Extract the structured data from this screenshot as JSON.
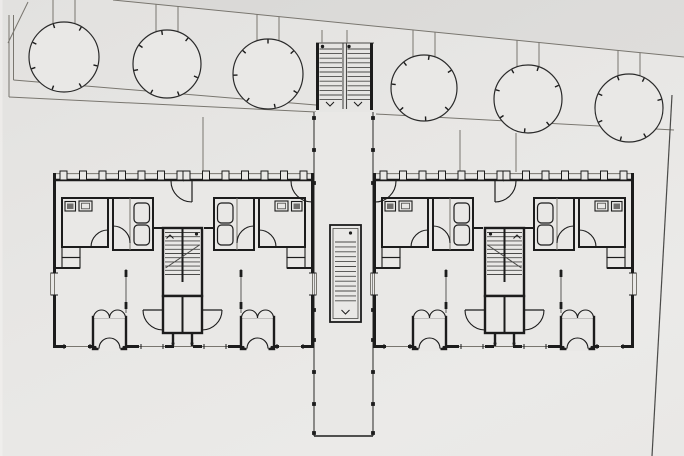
{
  "meta": {
    "title": "Architectural site plan — two mirrored residential buildings linked by a central stair walkway, tree row along the north boundary",
    "drawing_type": "ground-floor site plan, black ink on grey paper"
  },
  "colors": {
    "paper": "#e9e8e6",
    "paperlight": "#f4f3f1",
    "ink": "#1c1c1c",
    "med": "#4a4a48",
    "thin": "#79766f",
    "wc": "#6f6e6c",
    "none": "none"
  },
  "shading": {
    "above_boundary_opacity": 0.045,
    "left_edge_sliver_opacity": 0.55
  },
  "trees": [
    {
      "cx": 64,
      "cy": 57,
      "r": 35
    },
    {
      "cx": 167,
      "cy": 64,
      "r": 34
    },
    {
      "cx": 268,
      "cy": 74,
      "r": 35
    },
    {
      "cx": 424,
      "cy": 88,
      "r": 33
    },
    {
      "cx": 528,
      "cy": 99,
      "r": 34
    },
    {
      "cx": 629,
      "cy": 108,
      "r": 34
    }
  ],
  "tree_style": {
    "tick_angles": [
      15,
      60,
      110,
      160,
      205,
      252,
      300
    ],
    "tick_len": 4.5,
    "stake_offset": 11
  },
  "boundary": {
    "x1": 113,
    "y1": 0,
    "x2": 684,
    "y2": 57
  },
  "site": [
    {
      "t": "line",
      "x1": 113,
      "y1": 0,
      "x2": 684,
      "y2": 57,
      "s": 1,
      "c": "thin"
    },
    {
      "t": "line",
      "x1": 8,
      "y1": 43,
      "x2": 28,
      "y2": 2,
      "s": 1,
      "c": "thin"
    },
    {
      "t": "line",
      "x1": 9,
      "y1": 15,
      "x2": 9,
      "y2": 97,
      "s": 1,
      "c": "thin"
    },
    {
      "t": "line",
      "x1": 13.5,
      "y1": 15,
      "x2": 13.5,
      "y2": 80,
      "s": 1,
      "c": "thin"
    },
    {
      "t": "line",
      "x1": 9,
      "y1": 97,
      "x2": 316,
      "y2": 112,
      "s": 1,
      "c": "thin"
    },
    {
      "t": "line",
      "x1": 13.5,
      "y1": 80,
      "x2": 316,
      "y2": 105,
      "s": 1,
      "c": "thin"
    },
    {
      "t": "line",
      "x1": 376,
      "y1": 114,
      "x2": 674,
      "y2": 130,
      "s": 1,
      "c": "thin"
    },
    {
      "t": "line",
      "x1": 672,
      "y1": 95,
      "x2": 652,
      "y2": 456,
      "s": 1.2,
      "c": "med"
    },
    {
      "t": "line",
      "x1": 203,
      "y1": 117,
      "x2": 203,
      "y2": 172,
      "s": 1,
      "c": "thin"
    },
    {
      "t": "line",
      "x1": 460,
      "y1": 130,
      "x2": 460,
      "y2": 172,
      "s": 1,
      "c": "thin"
    },
    {
      "t": "line",
      "x1": 516,
      "y1": 133,
      "x2": 516,
      "y2": 172,
      "s": 1,
      "c": "thin"
    }
  ],
  "top_stair": [
    {
      "t": "line",
      "x1": 316,
      "y1": 43,
      "x2": 374,
      "y2": 43,
      "s": 1,
      "c": "med"
    },
    {
      "t": "line",
      "x1": 317.5,
      "y1": 43,
      "x2": 317.5,
      "y2": 110,
      "s": 3,
      "c": "ink"
    },
    {
      "t": "line",
      "x1": 371.5,
      "y1": 43,
      "x2": 371.5,
      "y2": 110,
      "s": 3,
      "c": "ink"
    },
    {
      "t": "line",
      "x1": 343,
      "y1": 43,
      "x2": 343,
      "y2": 109,
      "s": 1.1,
      "c": "med"
    },
    {
      "t": "line",
      "x1": 346.5,
      "y1": 43,
      "x2": 346.5,
      "y2": 109,
      "s": 1.1,
      "c": "med"
    },
    {
      "t": "treads",
      "x": 319.5,
      "y": 49,
      "w": 22.5,
      "n": 12,
      "step": 4.6
    },
    {
      "t": "treads",
      "x": 347.5,
      "y": 49,
      "w": 22.5,
      "n": 12,
      "step": 4.6
    },
    {
      "t": "dot",
      "cx": 322.5,
      "cy": 46.5,
      "r": 1.7
    },
    {
      "t": "dot",
      "cx": 349,
      "cy": 46.5,
      "r": 1.7
    },
    {
      "t": "varrow",
      "cx": 330,
      "cy": 106,
      "sz": 4
    },
    {
      "t": "varrow",
      "cx": 358,
      "cy": 106,
      "sz": 4
    },
    {
      "t": "line",
      "x1": 322,
      "y1": 30,
      "x2": 322,
      "y2": 43,
      "s": 1,
      "c": "thin"
    },
    {
      "t": "line",
      "x1": 347,
      "y1": 30,
      "x2": 347,
      "y2": 43,
      "s": 1,
      "c": "thin"
    }
  ],
  "spine": [
    {
      "t": "rect",
      "x": 314.5,
      "y": 112,
      "w": 58,
      "h": 324,
      "s": 0,
      "f": "paper"
    },
    {
      "t": "line",
      "x1": 314,
      "y1": 112,
      "x2": 314,
      "y2": 436,
      "s": 1.2,
      "c": "med"
    },
    {
      "t": "line",
      "x1": 373,
      "y1": 112,
      "x2": 373,
      "y2": 436,
      "s": 1.2,
      "c": "med"
    },
    {
      "t": "line",
      "x1": 314,
      "y1": 436,
      "x2": 373,
      "y2": 436,
      "s": 1.4,
      "c": "ink"
    },
    {
      "t": "posts",
      "xs": [
        314,
        373
      ],
      "ys": [
        118,
        150,
        183,
        310,
        340,
        372,
        404,
        433
      ],
      "sz": 3.8
    },
    {
      "t": "rect",
      "x": 330,
      "y": 225,
      "w": 31,
      "h": 97,
      "s": 1.8,
      "f": "paper"
    },
    {
      "t": "rect",
      "x": 333,
      "y": 228.5,
      "w": 25,
      "h": 90,
      "s": 0.8,
      "f": "none",
      "c": "med"
    },
    {
      "t": "treads",
      "x": 335,
      "y": 242,
      "w": 21,
      "n": 13,
      "step": 4.9
    },
    {
      "t": "dot",
      "cx": 350.5,
      "cy": 233,
      "r": 1.6
    },
    {
      "t": "varrow",
      "cx": 345.5,
      "cy": 314,
      "sz": 4
    }
  ],
  "building_template": {
    "W": 261,
    "H": 175,
    "half": [
      {
        "t": "line",
        "x1": 0,
        "y1": 0.6,
        "x2": 131,
        "y2": 0.6,
        "s": 1,
        "c": "thin"
      },
      {
        "t": "line",
        "x1": 0,
        "y1": 7,
        "x2": 131,
        "y2": 7,
        "s": 2.4,
        "c": "ink"
      },
      {
        "t": "windows",
        "x": 7,
        "y": -2,
        "n": 7,
        "step": 19.5,
        "w": 7,
        "h": 9
      },
      {
        "t": "line",
        "x1": 1.5,
        "y1": 0,
        "x2": 1.5,
        "y2": 100,
        "s": 3,
        "c": "ink"
      },
      {
        "t": "line",
        "x1": 1.5,
        "y1": 122,
        "x2": 1.5,
        "y2": 175,
        "s": 3,
        "c": "ink"
      },
      {
        "t": "line",
        "x1": 1.5,
        "y1": 100,
        "x2": 1.5,
        "y2": 122,
        "s": 1,
        "c": "thin"
      },
      {
        "t": "line",
        "x1": -2.5,
        "y1": 100,
        "x2": 5,
        "y2": 100,
        "s": 1,
        "c": "ink"
      },
      {
        "t": "line",
        "x1": -2.5,
        "y1": 122,
        "x2": 5,
        "y2": 122,
        "s": 1,
        "c": "ink"
      },
      {
        "t": "line",
        "x1": -2.5,
        "y1": 100,
        "x2": -2.5,
        "y2": 122,
        "s": 1,
        "c": "thin"
      },
      {
        "t": "line",
        "x1": 0,
        "y1": 173.5,
        "x2": 13,
        "y2": 173.5,
        "s": 3,
        "c": "ink"
      },
      {
        "t": "line",
        "x1": 13,
        "y1": 173.5,
        "x2": 35,
        "y2": 173.5,
        "s": 1,
        "c": "thin"
      },
      {
        "t": "line",
        "x1": 11,
        "y1": 171,
        "x2": 11,
        "y2": 176,
        "s": 1,
        "c": "ink"
      },
      {
        "t": "line",
        "x1": 37,
        "y1": 171,
        "x2": 37,
        "y2": 176,
        "s": 1,
        "c": "ink"
      },
      {
        "t": "line",
        "x1": 35,
        "y1": 173.5,
        "x2": 42,
        "y2": 173.5,
        "s": 3,
        "c": "ink"
      },
      {
        "t": "line",
        "x1": 71,
        "y1": 173.5,
        "x2": 86,
        "y2": 173.5,
        "s": 3,
        "c": "ink"
      },
      {
        "t": "line",
        "x1": 86,
        "y1": 173.5,
        "x2": 112,
        "y2": 173.5,
        "s": 1,
        "c": "thin"
      },
      {
        "t": "line",
        "x1": 88,
        "y1": 171,
        "x2": 88,
        "y2": 176,
        "s": 1,
        "c": "ink"
      },
      {
        "t": "line",
        "x1": 110,
        "y1": 171,
        "x2": 110,
        "y2": 176,
        "s": 1,
        "c": "ink"
      },
      {
        "t": "line",
        "x1": 112,
        "y1": 173.5,
        "x2": 121,
        "y2": 173.5,
        "s": 3,
        "c": "ink"
      },
      {
        "t": "line",
        "x1": 121,
        "y1": 173.5,
        "x2": 131,
        "y2": 173.5,
        "s": 1,
        "c": "thin"
      },
      {
        "t": "rect",
        "x": 40,
        "y": 144,
        "w": 33,
        "h": 32,
        "s": 2.4,
        "f": "paper"
      },
      {
        "t": "sarc",
        "cx": 48.5,
        "cy": 145,
        "r": 8,
        "s": 1.1
      },
      {
        "t": "sarc",
        "cx": 64.5,
        "cy": 145,
        "r": 8,
        "s": 1.1
      },
      {
        "t": "rect",
        "x": 45.5,
        "y": 172.5,
        "w": 22,
        "h": 5.5,
        "s": 0,
        "f": "paper"
      },
      {
        "t": "qarc",
        "x1": 46,
        "y1": 175.5,
        "x2": 56.5,
        "y2": 165,
        "sw": 1,
        "s": 1.1
      },
      {
        "t": "qarc",
        "x1": 67,
        "y1": 175.5,
        "x2": 56.5,
        "y2": 165,
        "sw": 0,
        "s": 1.1
      },
      {
        "t": "dot",
        "cx": 42,
        "cy": 174.5,
        "r": 1.6
      },
      {
        "t": "dot",
        "cx": 71,
        "cy": 174.5,
        "r": 1.6
      },
      {
        "t": "line",
        "x1": 73,
        "y1": 96,
        "x2": 73,
        "y2": 140,
        "s": 0.9,
        "c": "med"
      },
      {
        "t": "rect",
        "x": 71.6,
        "y": 97,
        "w": 2.8,
        "h": 7,
        "s": 0,
        "f": "ink"
      },
      {
        "t": "rect",
        "x": 71.6,
        "y": 129,
        "w": 2.8,
        "h": 7,
        "s": 0,
        "f": "ink"
      },
      {
        "t": "rect",
        "x": 9,
        "y": 25,
        "w": 46,
        "h": 49,
        "s": 2,
        "f": "none"
      },
      {
        "t": "rect",
        "x": 12,
        "y": 28.5,
        "w": 10.5,
        "h": 9.5,
        "s": 1.1,
        "f": "paper"
      },
      {
        "t": "rect",
        "x": 14,
        "y": 30.5,
        "w": 6.5,
        "h": 5.5,
        "s": 0,
        "f": "wc"
      },
      {
        "t": "rect",
        "x": 26,
        "y": 28,
        "w": 13,
        "h": 10,
        "s": 1.1,
        "f": "paper"
      },
      {
        "t": "rect",
        "x": 28.5,
        "y": 30.2,
        "w": 8,
        "h": 5.6,
        "s": 0.8,
        "f": "none",
        "c": "med"
      },
      {
        "t": "qarc",
        "x1": 38,
        "y1": 74,
        "x2": 55,
        "y2": 57,
        "sw": 1,
        "s": 1.1
      },
      {
        "t": "rect",
        "x": 9,
        "y": 74,
        "w": 18,
        "h": 10.5,
        "s": 1.1,
        "f": "none"
      },
      {
        "t": "rect",
        "x": 9,
        "y": 84.5,
        "w": 18,
        "h": 10.5,
        "s": 1.1,
        "f": "none"
      },
      {
        "t": "line",
        "x1": 0,
        "y1": 95,
        "x2": 27,
        "y2": 95,
        "s": 2,
        "c": "ink"
      },
      {
        "t": "rect",
        "x": 60,
        "y": 25,
        "w": 40,
        "h": 52,
        "s": 2,
        "f": "none"
      },
      {
        "t": "rect",
        "x": 81,
        "y": 30,
        "w": 15.5,
        "h": 20,
        "rx": 4,
        "s": 1.2,
        "f": "paper"
      },
      {
        "t": "rect",
        "x": 81,
        "y": 52,
        "w": 15.5,
        "h": 20,
        "rx": 4,
        "s": 1.2,
        "f": "paper"
      },
      {
        "t": "line",
        "x1": 77,
        "y1": 25,
        "x2": 77,
        "y2": 77,
        "s": 1,
        "c": "thin"
      },
      {
        "t": "qarc",
        "x1": 60,
        "y1": 53,
        "x2": 77,
        "y2": 70,
        "sw": 1,
        "s": 1.1
      },
      {
        "t": "line",
        "x1": 55,
        "y1": 25,
        "x2": 60,
        "y2": 25,
        "s": 2,
        "c": "ink"
      },
      {
        "t": "line",
        "x1": 100,
        "y1": 55,
        "x2": 110,
        "y2": 55,
        "s": 2,
        "c": "ink"
      }
    ],
    "once": [
      {
        "t": "rect",
        "x": 110,
        "y": 55,
        "w": 39,
        "h": 68,
        "s": 2.4,
        "f": "paper"
      },
      {
        "t": "treads",
        "x": 112,
        "y": 59.5,
        "w": 35,
        "n": 11,
        "step": 4.2
      },
      {
        "t": "line",
        "x1": 129.5,
        "y1": 55,
        "x2": 129.5,
        "y2": 109,
        "s": 2,
        "c": "ink"
      },
      {
        "t": "line",
        "x1": 112.5,
        "y1": 95,
        "x2": 146.5,
        "y2": 72,
        "s": 1,
        "c": "med"
      },
      {
        "t": "aarrow",
        "cx": 117,
        "cy": 62,
        "sz": 3.5
      },
      {
        "t": "dot",
        "cx": 143.5,
        "cy": 61,
        "r": 1.6
      },
      {
        "t": "rect",
        "x": 110,
        "y": 123,
        "w": 39,
        "h": 37,
        "s": 2.4,
        "f": "paper"
      },
      {
        "t": "line",
        "x1": 129.5,
        "y1": 123,
        "x2": 129.5,
        "y2": 160,
        "s": 2,
        "c": "ink"
      },
      {
        "t": "qarc",
        "x1": 90,
        "y1": 137,
        "x2": 110,
        "y2": 157,
        "sw": 0,
        "s": 1.1
      },
      {
        "t": "line",
        "x1": 90,
        "y1": 137,
        "x2": 110,
        "y2": 137,
        "s": 1.2,
        "c": "ink"
      },
      {
        "t": "qarc",
        "x1": 169,
        "y1": 137,
        "x2": 149,
        "y2": 157,
        "sw": 1,
        "s": 1.1
      },
      {
        "t": "line",
        "x1": 149,
        "y1": 137,
        "x2": 169,
        "y2": 137,
        "s": 1.2,
        "c": "ink"
      },
      {
        "t": "line",
        "x1": 120,
        "y1": 160,
        "x2": 120,
        "y2": 173,
        "s": 2.4,
        "c": "ink"
      },
      {
        "t": "line",
        "x1": 139,
        "y1": 160,
        "x2": 139,
        "y2": 173,
        "s": 2.4,
        "c": "ink"
      },
      {
        "t": "dot",
        "cx": 120,
        "cy": 170.5,
        "r": 1.5
      },
      {
        "t": "dot",
        "cx": 139,
        "cy": 170.5,
        "r": 1.5
      },
      {
        "t": "line",
        "x1": 139,
        "y1": 8,
        "x2": 139,
        "y2": 29,
        "s": 1.2,
        "c": "ink"
      },
      {
        "t": "qarc",
        "x1": 118,
        "y1": 8,
        "x2": 139,
        "y2": 29,
        "sw": 0,
        "s": 1.1
      },
      {
        "t": "line",
        "x1": 259,
        "y1": 8,
        "x2": 259,
        "y2": 29,
        "s": 1.2,
        "c": "ink"
      },
      {
        "t": "qarc",
        "x1": 238,
        "y1": 8,
        "x2": 259,
        "y2": 29,
        "sw": 0,
        "s": 1.1
      }
    ]
  },
  "buildings": [
    {
      "name": "west-building",
      "x": 53,
      "y": 173,
      "mirror": false
    },
    {
      "name": "east-building",
      "x": 373,
      "y": 173,
      "mirror": true
    }
  ]
}
